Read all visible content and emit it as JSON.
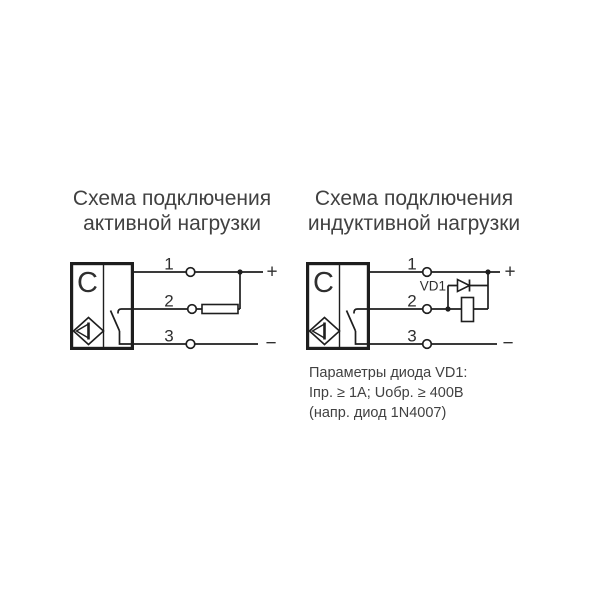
{
  "left_diagram": {
    "title_line1": "Схема подключения",
    "title_line2": "активной нагрузки",
    "device_label": "C",
    "terminals": [
      "1",
      "2",
      "3"
    ],
    "plus": "+",
    "minus": "−"
  },
  "right_diagram": {
    "title_line1": "Схема подключения",
    "title_line2": "индуктивной нагрузки",
    "device_label": "C",
    "terminals": [
      "1",
      "2",
      "3"
    ],
    "diode_label": "VD1",
    "plus": "+",
    "minus": "−"
  },
  "diode_note": {
    "line1": "Параметры диода VD1:",
    "line2": "Iпр. ≥ 1А; Uобр. ≥ 400В",
    "line3": "(напр. диод 1N4007)"
  },
  "colors": {
    "line": "#1e1e1e",
    "diagram_text": "#2f2f2f",
    "caption_text": "#414141",
    "background": "#ffffff"
  }
}
